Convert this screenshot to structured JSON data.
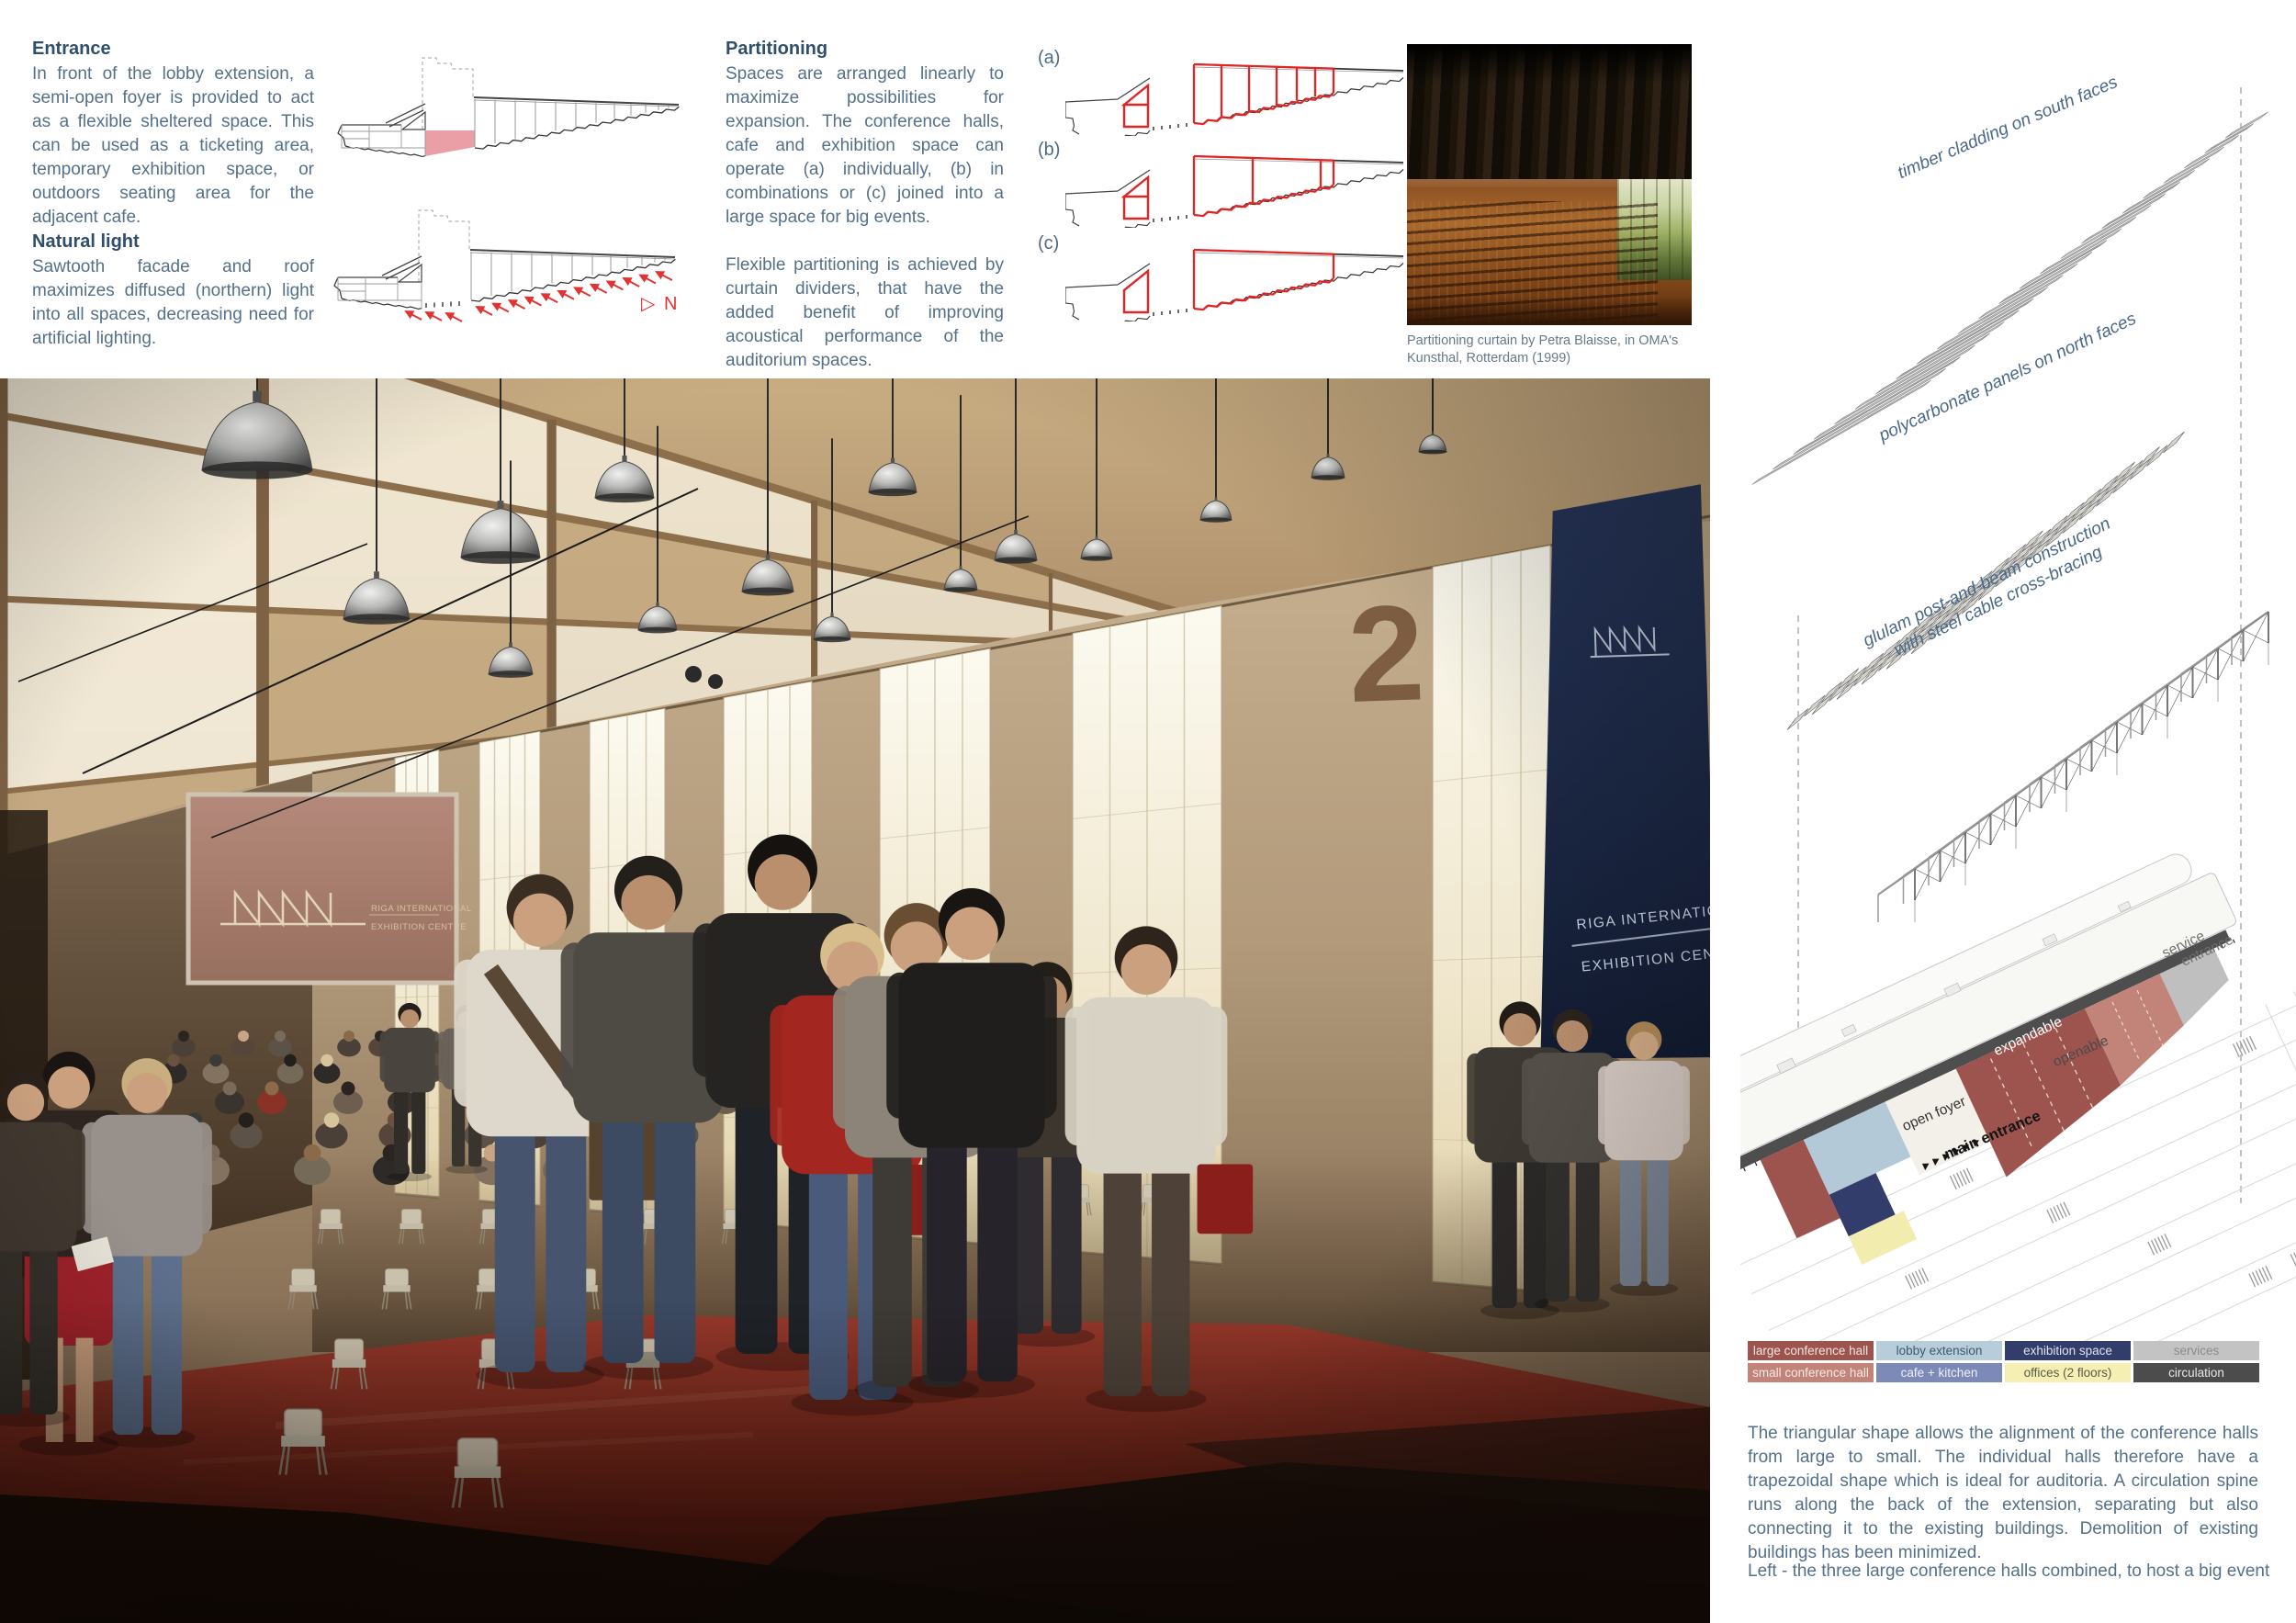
{
  "board": {
    "entrance": {
      "title": "Entrance",
      "body": "In front of the lobby extension, a semi-open foyer is provided to act as a flexible sheltered space. This can be used as a ticketing area, temporary exhibition space, or outdoors seating area for the adjacent cafe."
    },
    "natural_light": {
      "title": "Natural light",
      "body": "Sawtooth facade and roof maximizes diffused (northern) light into all spaces, decreasing need for artificial lighting."
    },
    "partitioning": {
      "title": "Partitioning",
      "body1": "Spaces are arranged linearly to maximize possibilities for expansion. The conference halls, cafe and exhibition space can operate (a) individually, (b) in combinations or (c) joined into a large space for big events.",
      "body2": "Flexible partitioning is achieved by curtain dividers, that have the added benefit of improving acoustical performance of the auditorium spaces."
    },
    "icons": {
      "north_pointer": "▷"
    },
    "north_label": "N",
    "diagram_labels": {
      "a": "(a)",
      "b": "(b)",
      "c": "(c)"
    },
    "kunsthal_caption": "Partitioning curtain by Petra Blaisse, in OMA's Kunsthal, Rotterdam (1999)",
    "axon": {
      "label_timber": "timber cladding on south faces",
      "label_poly": "polycarbonate panels on north faces",
      "label_glulam_1": "glulam post-and-beam construction",
      "label_glulam_2": "with steel cable cross-bracing"
    },
    "plan": {
      "service_1": "service",
      "service_2": "entrance",
      "expandable": "expandable",
      "openable": "openable",
      "open_foyer": "open foyer",
      "main_entrance": "main entrance"
    },
    "legend": {
      "items": [
        {
          "label": "large conference hall",
          "bg": "#9e544e",
          "fg": "#f3e3e1"
        },
        {
          "label": "lobby extension",
          "bg": "#b8cdda",
          "fg": "#3d5a70"
        },
        {
          "label": "exhibition space",
          "bg": "#323d6b",
          "fg": "#dfe3ef"
        },
        {
          "label": "services",
          "bg": "#c3c3c3",
          "fg": "#8b8b8b"
        },
        {
          "label": "small conference hall",
          "bg": "#c28379",
          "fg": "#f6e9e6"
        },
        {
          "label": "cafe + kitchen",
          "bg": "#7d8ab7",
          "fg": "#eef0f7"
        },
        {
          "label": "offices (2 floors)",
          "bg": "#f5efb4",
          "fg": "#5a5a4a"
        },
        {
          "label": "circulation",
          "bg": "#4c4c4c",
          "fg": "#e8e8e8"
        }
      ]
    },
    "description": "The triangular shape allows the alignment of the conference halls from large to small. The individual halls therefore have a trapezoidal shape which is ideal for auditoria. A circulation spine runs along the back of the extension, separating but also connecting it to the existing buildings. Demolition of existing buildings has been minimized.",
    "bottom_caption": "Left - the three large conference halls combined, to host a big event",
    "render": {
      "wall_number": "2",
      "banner_line1": "RIGA INTERNATIONAL",
      "banner_line2": "EXHIBITION CENTRE",
      "screen_line1": "RIGA INTERNATIONAL",
      "screen_line2": "EXHIBITION CENTRE"
    },
    "colors": {
      "diagram_red": "#e02525",
      "highlight_pink": "#e8949c",
      "text_heading": "#2f4e6b",
      "text_body": "#54708a"
    }
  }
}
